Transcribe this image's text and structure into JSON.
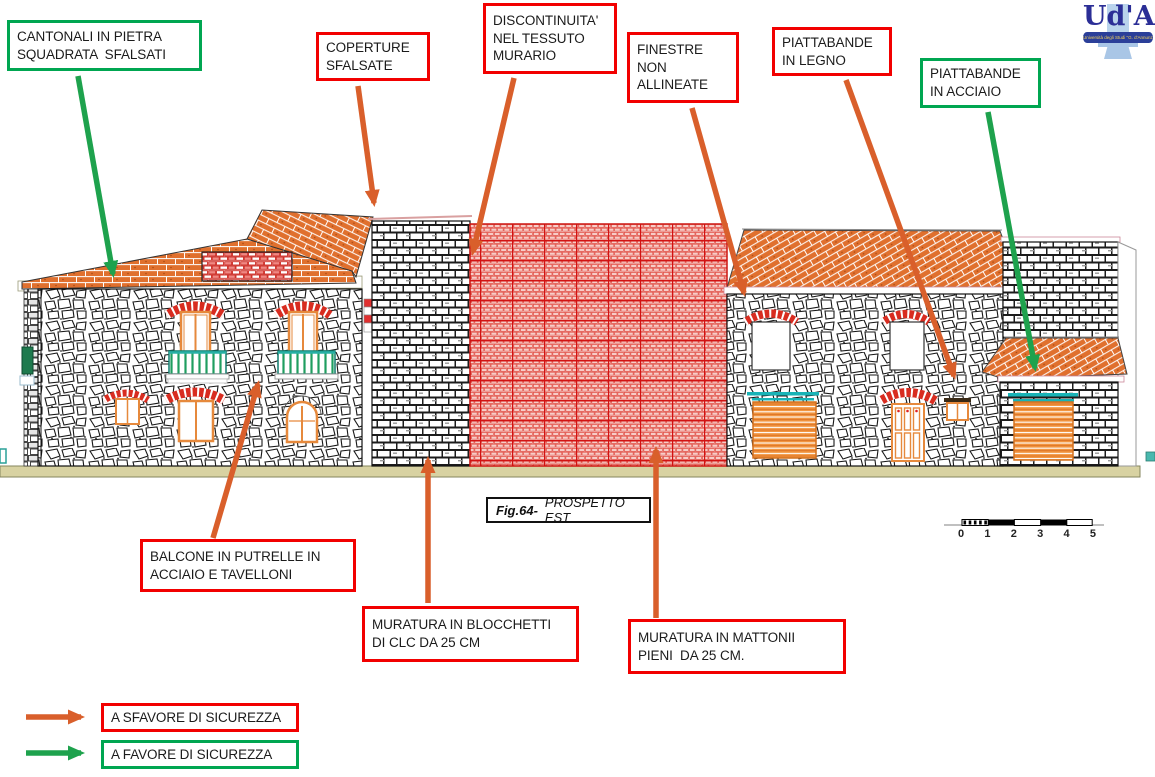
{
  "figure": {
    "type": "architectural elevation diagram",
    "caption": {
      "fig": "Fig.64-",
      "title": "PROSPETTO EST"
    }
  },
  "logo": {
    "text": "Ud'A",
    "banner": "Università degli Studi \"G. d'Annunzio\""
  },
  "annotations": [
    {
      "id": "cantonali",
      "type": "favore",
      "text": "CANTONALI IN PIETRA\nSQUADRATA  SFALSATI"
    },
    {
      "id": "coperture",
      "type": "sfavore",
      "text": "COPERTURE\nSFALSATE"
    },
    {
      "id": "discontinuita",
      "type": "sfavore",
      "text": "DISCONTINUITA'\nNEL TESSUTO\nMURARIO"
    },
    {
      "id": "finestre",
      "type": "sfavore",
      "text": "FINESTRE\nNON\nALLINEATE"
    },
    {
      "id": "piattabande-legno",
      "type": "sfavore",
      "text": "PIATTABANDE\nIN LEGNO"
    },
    {
      "id": "piattabande-acciaio",
      "type": "favore",
      "text": "PIATTABANDE\nIN ACCIAIO"
    },
    {
      "id": "balcone",
      "type": "sfavore",
      "text": "BALCONE IN PUTRELLE IN\nACCIAIO E TAVELLONI"
    },
    {
      "id": "blocchetti",
      "type": "sfavore",
      "text": "MURATURA IN BLOCCHETTI\nDI CLC DA 25 CM"
    },
    {
      "id": "mattonii",
      "type": "sfavore",
      "text": "MURATURA IN MATTONII\nPIENI  DA 25 CM."
    }
  ],
  "legend": {
    "sfavore": {
      "label": "A SFAVORE DI SICUREZZA",
      "box_color": "#f20000",
      "arrow_color": "#d95f2b"
    },
    "favore": {
      "label": "A FAVORE DI SICUREZZA",
      "box_color": "#00a651",
      "arrow_color": "#1ea24d"
    }
  },
  "scalebar": {
    "ticks": [
      "0",
      "1",
      "2",
      "3",
      "4",
      "5"
    ]
  },
  "colors": {
    "annotation_red": "#f20000",
    "annotation_green": "#00a651",
    "arrow_orange": "#d95f2b",
    "arrow_green": "#1ea24d",
    "roof_tile": "#e0702e",
    "red_brick_wall": "#d21212",
    "steel_lintel_teal": "#19b3b6",
    "window_frame_orange": "#e6893c",
    "railing_green": "#1f9e60",
    "ground": "#d8d2a2"
  }
}
